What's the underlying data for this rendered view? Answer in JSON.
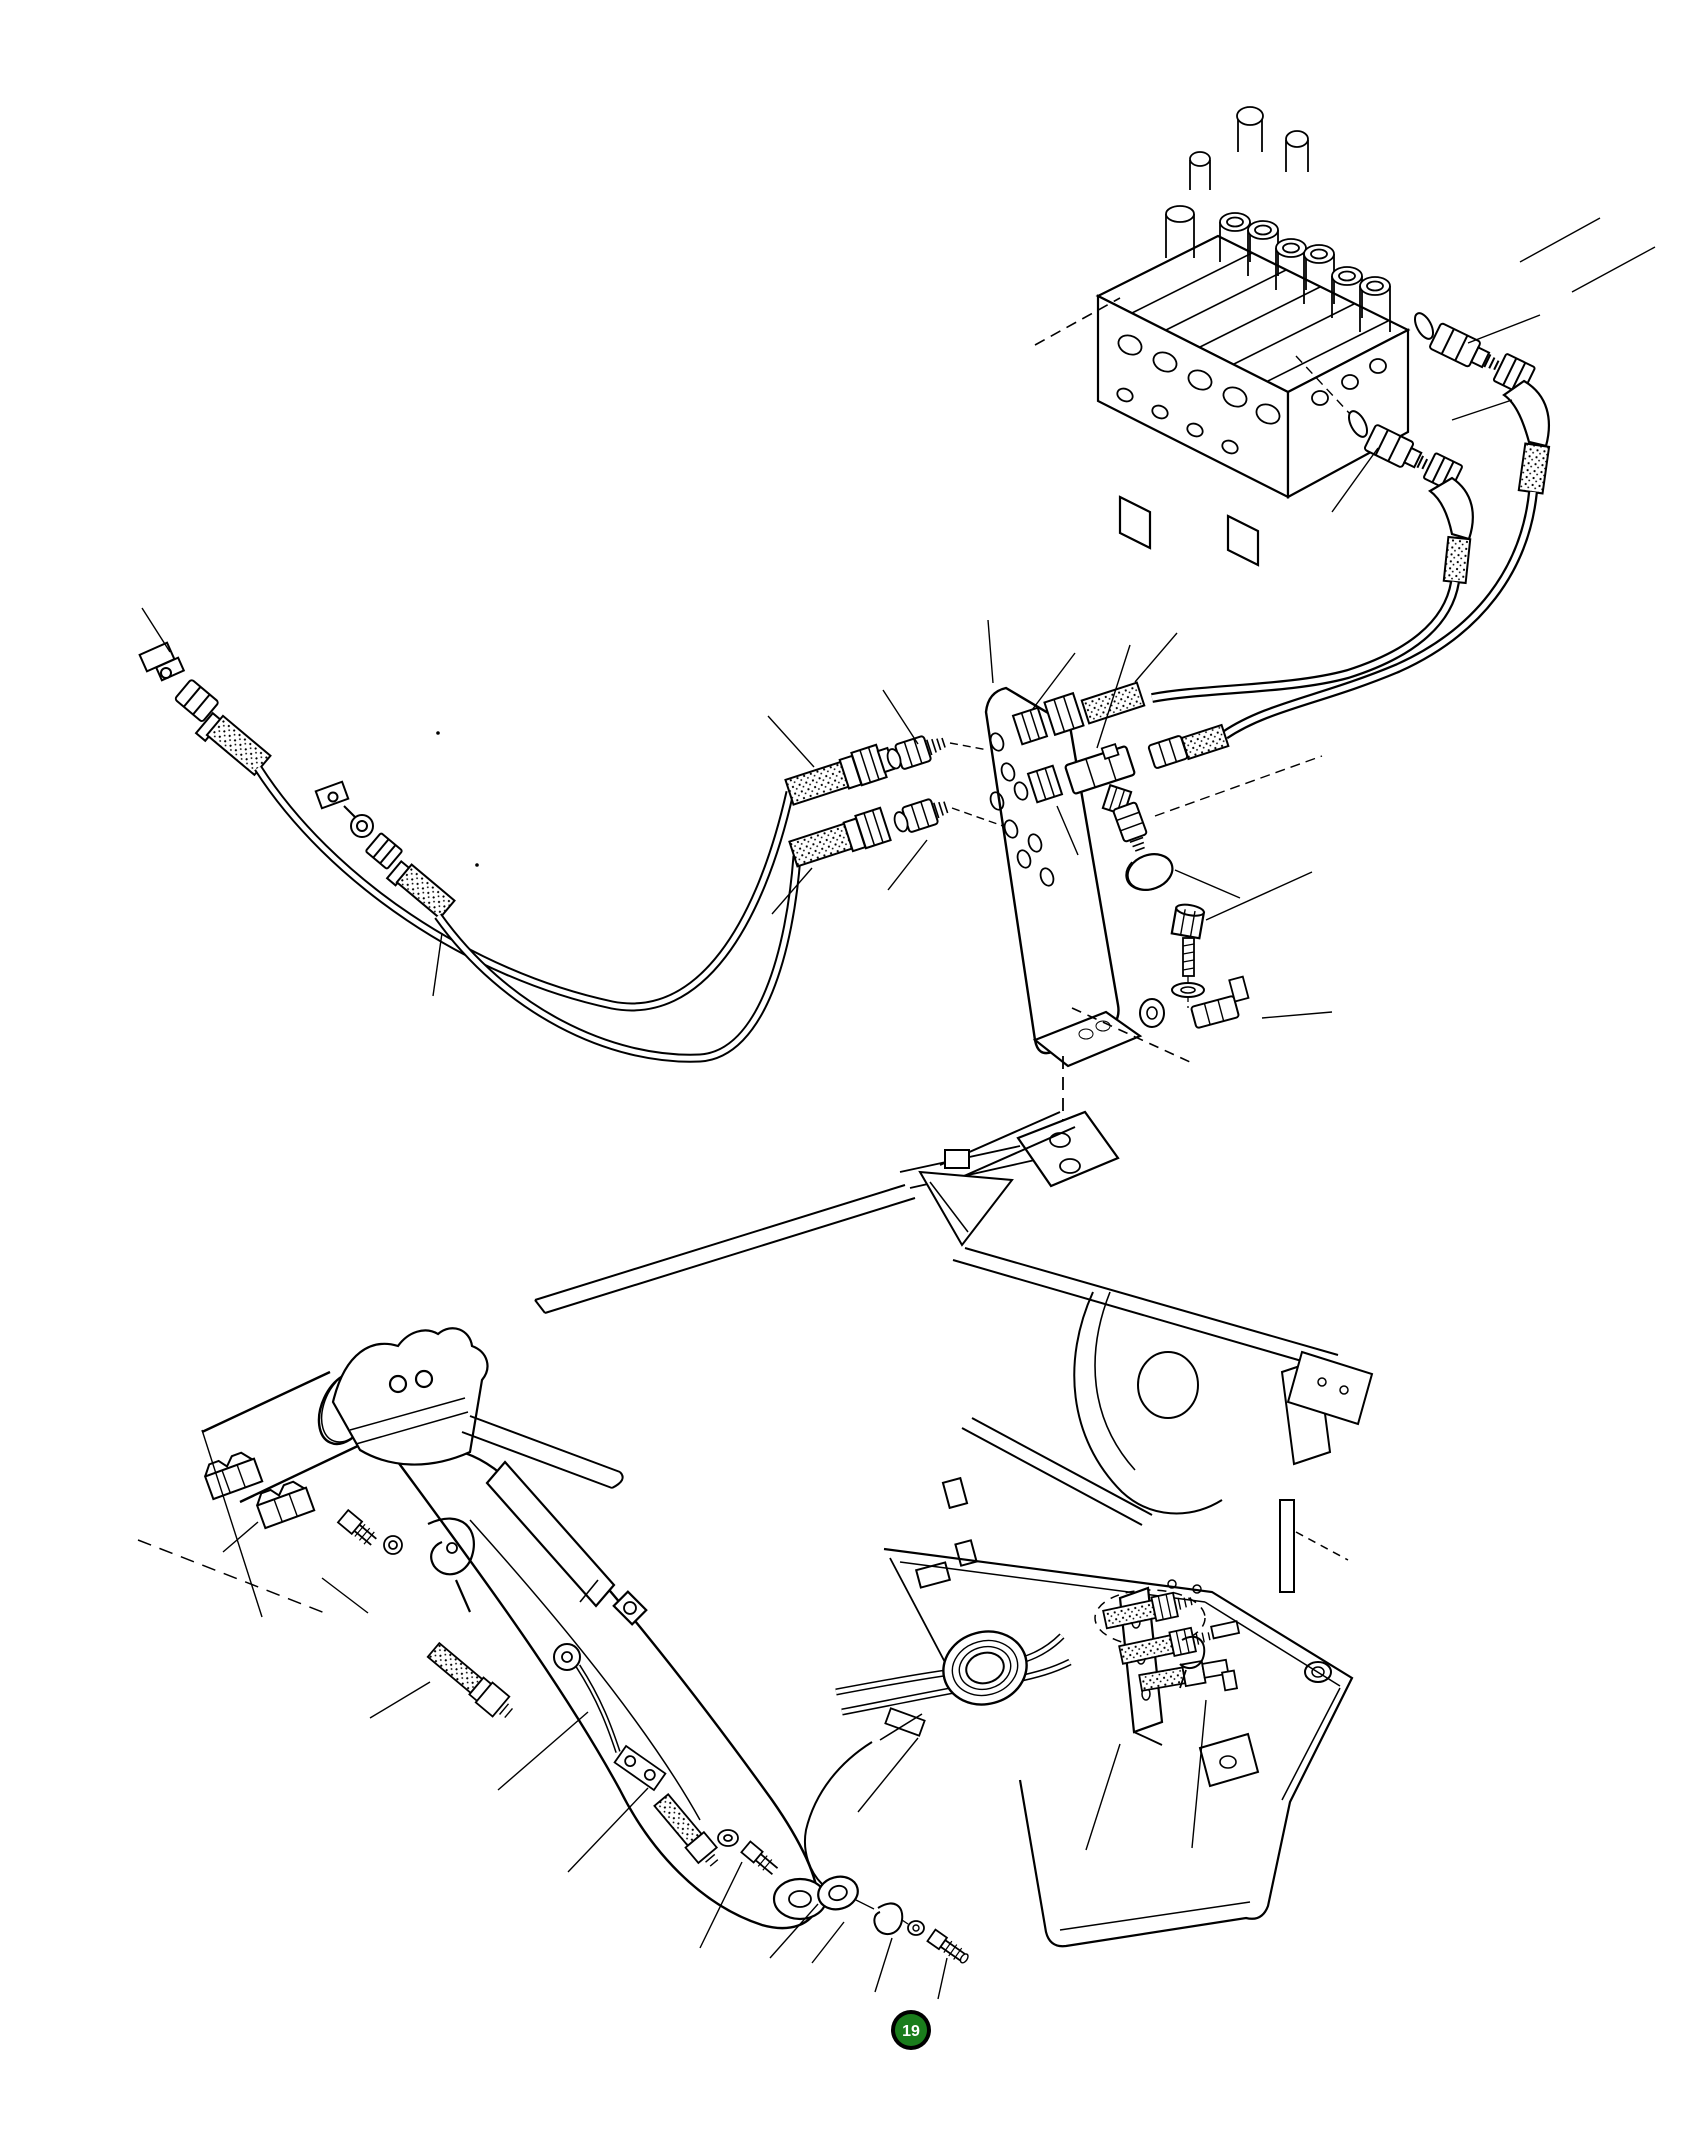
{
  "page": {
    "width_px": 1688,
    "height_px": 2150,
    "background": "#ffffff"
  },
  "drawing": {
    "ink_color": "#000000",
    "kind": "exploded hydraulic piping parts diagram"
  },
  "callout": {
    "number": "19",
    "fill": "#1a7d1c",
    "ring": "#000000",
    "text_color": "#ffffff"
  }
}
